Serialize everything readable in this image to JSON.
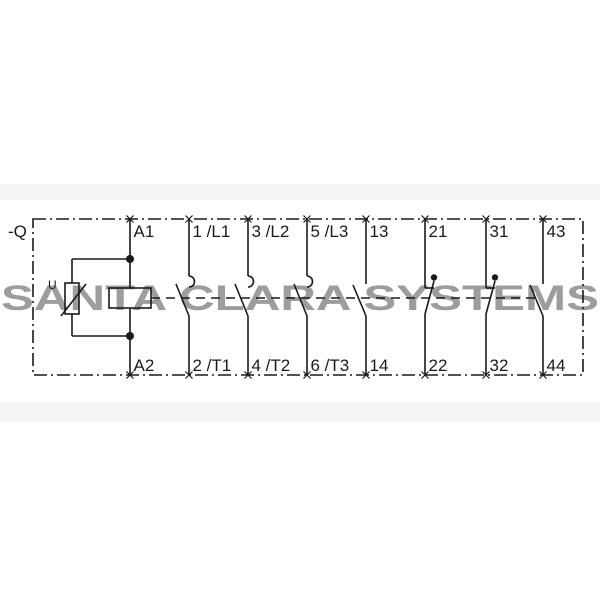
{
  "schematic": {
    "device_label": "-Q",
    "varistor_label": "U",
    "coil_terminals": {
      "top": "A1",
      "bottom": "A2"
    },
    "columns": [
      {
        "id": "coil",
        "type": "coil",
        "top": "A1",
        "bottom": "A2"
      },
      {
        "id": "main-pole-1",
        "type": "main-no",
        "top": "1 /L1",
        "bottom": "2 /T1"
      },
      {
        "id": "main-pole-2",
        "type": "main-no",
        "top": "3 /L2",
        "bottom": "4 /T2"
      },
      {
        "id": "main-pole-3",
        "type": "main-no",
        "top": "5 /L3",
        "bottom": "6 /T3"
      },
      {
        "id": "aux-no-13",
        "type": "aux-no",
        "top": "13",
        "bottom": "14"
      },
      {
        "id": "aux-nc-21",
        "type": "aux-nc",
        "top": "21",
        "bottom": "22"
      },
      {
        "id": "aux-nc-31",
        "type": "aux-nc",
        "top": "31",
        "bottom": "32"
      },
      {
        "id": "aux-no-43",
        "type": "aux-no",
        "top": "43",
        "bottom": "44"
      }
    ]
  },
  "watermark": {
    "text": "SANTA CLARA SYSTEMS",
    "color": "#9d9d9d"
  },
  "colors": {
    "line": "#1a1a1a",
    "background": "#ffffff",
    "band": "#f4f4f4"
  }
}
